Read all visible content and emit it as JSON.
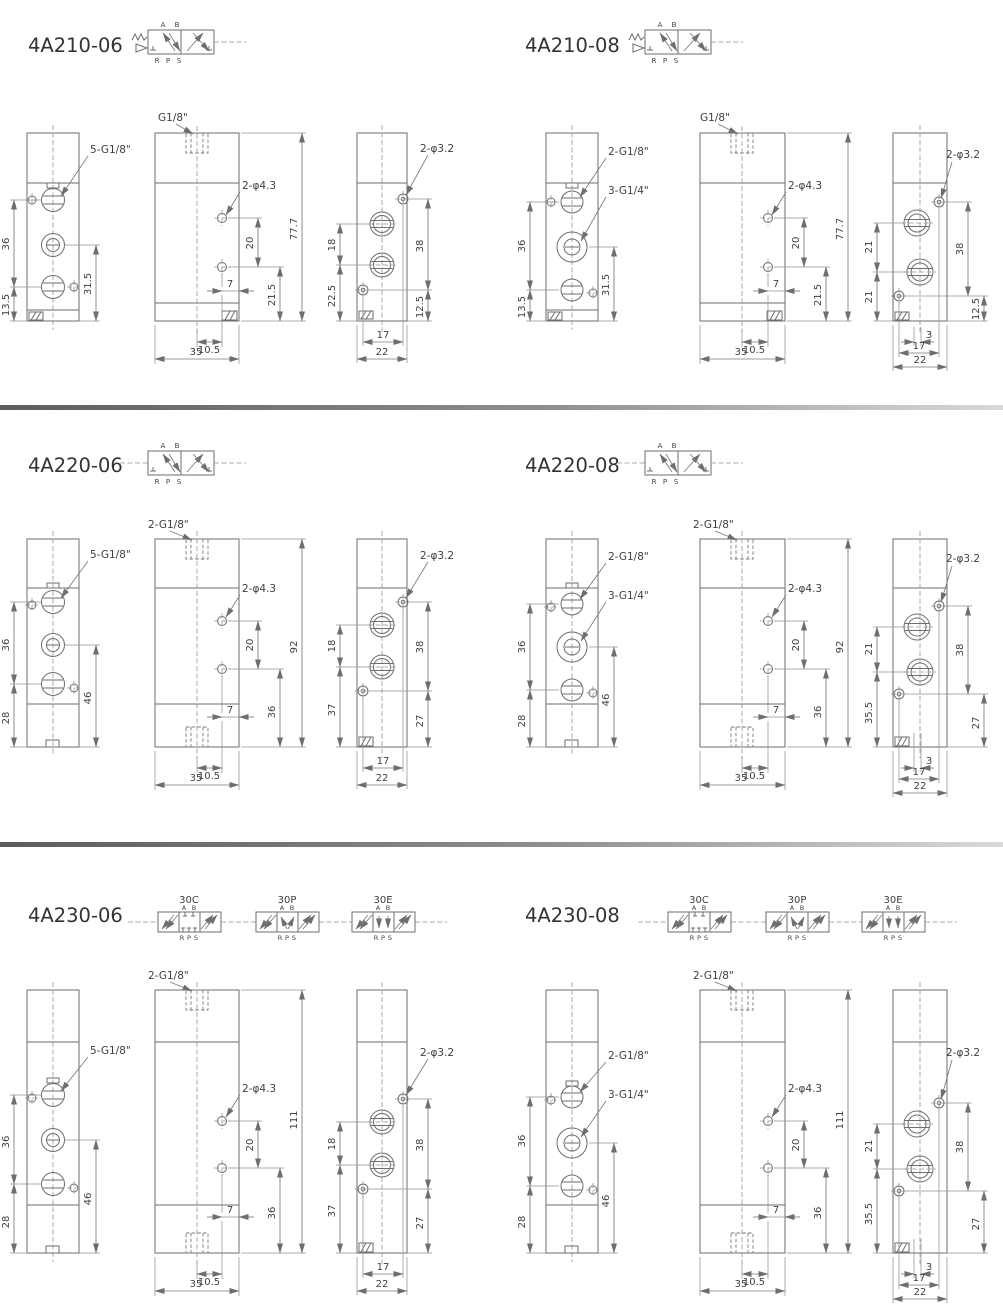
{
  "colors": {
    "background": "#ffffff",
    "line": "#6e6e6e",
    "text": "#404040",
    "separator_dark": "#5c5c5c",
    "separator_light": "#d9d9d9"
  },
  "sym": {
    "A": "A",
    "B": "B",
    "R": "R",
    "P": "P",
    "S": "S"
  },
  "sym3": [
    "30C",
    "30P",
    "30E"
  ],
  "panels": [
    {
      "title": "4A210-06",
      "front": {
        "label": "5-G1/8\"",
        "d1": "36",
        "d2": "13.5",
        "d3": "31.5"
      },
      "side": {
        "thread": "G1/8\"",
        "holes": "2-φ4.3",
        "height": "77.7",
        "s1": "20",
        "s2": "21.5",
        "off": "7",
        "c": "10.5",
        "w": "35"
      },
      "end": {
        "holes": "2-φ3.2",
        "l1": "18",
        "l2": "22.5",
        "r1": "38",
        "r2": "12.5",
        "b1": "17",
        "b2": "22"
      }
    },
    {
      "title": "4A210-08",
      "front": {
        "label1": "2-G1/8\"",
        "label2": "3-G1/4\"",
        "d1": "36",
        "d2": "13.5",
        "d3": "31.5"
      },
      "side": {
        "thread": "G1/8\"",
        "holes": "2-φ4.3",
        "height": "77.7",
        "s1": "20",
        "s2": "21.5",
        "off": "7",
        "c": "10.5",
        "w": "35"
      },
      "end": {
        "holes": "2-φ3.2",
        "l1": "21",
        "l2": "21",
        "r1": "38",
        "r2": "12.5",
        "b0": "3",
        "b1": "17",
        "b2": "22"
      }
    },
    {
      "title": "4A220-06",
      "front": {
        "label": "5-G1/8\"",
        "d1": "36",
        "d2": "28",
        "d3": "46"
      },
      "side": {
        "thread": "2-G1/8\"",
        "holes": "2-φ4.3",
        "height": "92",
        "s1": "20",
        "s2": "36",
        "off": "7",
        "c": "10.5",
        "w": "35"
      },
      "end": {
        "holes": "2-φ3.2",
        "l1": "18",
        "l2": "37",
        "r1": "38",
        "r2": "27",
        "b1": "17",
        "b2": "22"
      }
    },
    {
      "title": "4A220-08",
      "front": {
        "label1": "2-G1/8\"",
        "label2": "3-G1/4\"",
        "d1": "36",
        "d2": "28",
        "d3": "46"
      },
      "side": {
        "thread": "2-G1/8\"",
        "holes": "2-φ4.3",
        "height": "92",
        "s1": "20",
        "s2": "36",
        "off": "7",
        "c": "10.5",
        "w": "35"
      },
      "end": {
        "holes": "2-φ3.2",
        "l1": "21",
        "l2": "35.5",
        "r1": "38",
        "r2": "27",
        "b0": "3",
        "b1": "17",
        "b2": "22"
      }
    },
    {
      "title": "4A230-06",
      "front": {
        "label": "5-G1/8\"",
        "d1": "36",
        "d2": "28",
        "d3": "46"
      },
      "side": {
        "thread": "2-G1/8\"",
        "holes": "2-φ4.3",
        "height": "111",
        "s1": "20",
        "s2": "36",
        "off": "7",
        "c": "10.5",
        "w": "35"
      },
      "end": {
        "holes": "2-φ3.2",
        "l1": "18",
        "l2": "37",
        "r1": "38",
        "r2": "27",
        "b1": "17",
        "b2": "22"
      }
    },
    {
      "title": "4A230-08",
      "front": {
        "label1": "2-G1/8\"",
        "label2": "3-G1/4\"",
        "d1": "36",
        "d2": "28",
        "d3": "46"
      },
      "side": {
        "thread": "2-G1/8\"",
        "holes": "2-φ4.3",
        "height": "111",
        "s1": "20",
        "s2": "36",
        "off": "7",
        "c": "10.5",
        "w": "35"
      },
      "end": {
        "holes": "2-φ3.2",
        "l1": "21",
        "l2": "35.5",
        "r1": "38",
        "r2": "27",
        "b0": "3",
        "b1": "17",
        "b2": "22"
      }
    }
  ]
}
